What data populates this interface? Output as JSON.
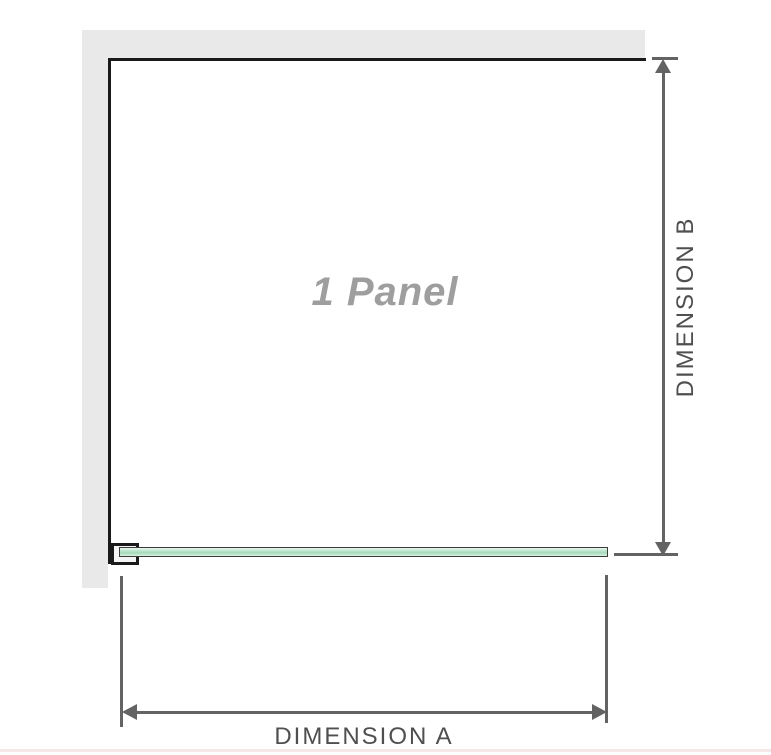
{
  "diagram": {
    "title": "Shower panel dimension diagram",
    "panel_label": "1 Panel",
    "dimension_a": {
      "label": "DIMENSION A",
      "orientation": "horizontal"
    },
    "dimension_b": {
      "label": "DIMENSION B",
      "orientation": "vertical"
    },
    "colors": {
      "wall_strip": "#e9e9e9",
      "panel_outline": "#1a1a1a",
      "dimension_lines": "#636363",
      "dimension_text": "#4f4f4f",
      "panel_label_text": "#9e9e9e",
      "glass_fill_light": "#e7f6ee",
      "glass_fill_mid": "#a5d8bb",
      "glass_border": "#3c3c3c",
      "bottom_rule": "#f3e8e6"
    }
  }
}
